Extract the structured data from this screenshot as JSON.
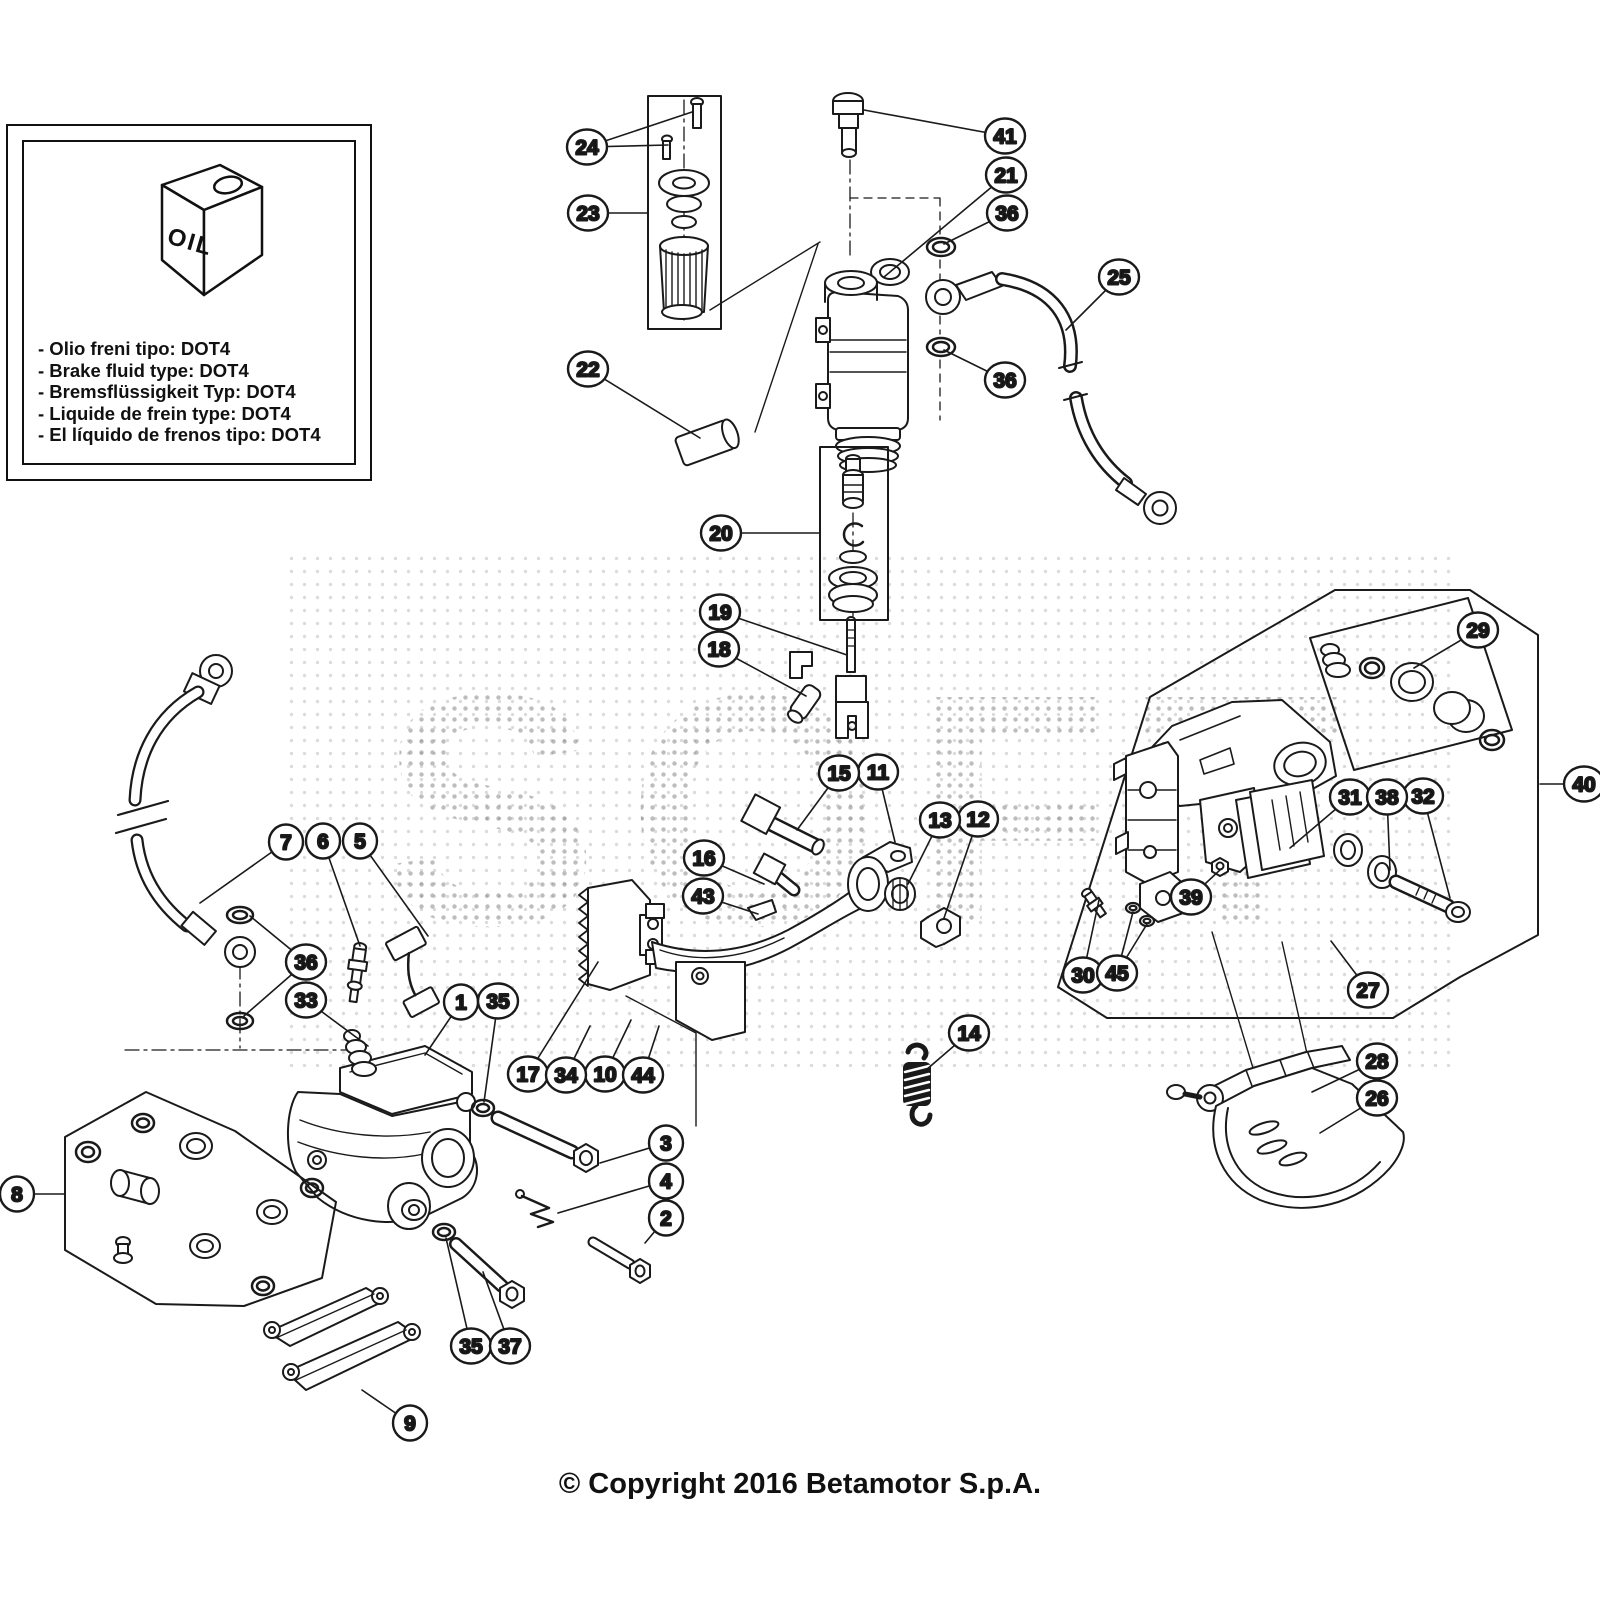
{
  "info_box": {
    "oil_label": "OIL",
    "lines": [
      "- Olio freni tipo: DOT4",
      "- Brake fluid type: DOT4",
      "- Bremsflüssigkeit Typ: DOT4",
      "- Liquide de frein type: DOT4",
      "- El líquido de frenos tipo: DOT4"
    ]
  },
  "watermark": {
    "text": "SOFT"
  },
  "copyright": "© Copyright 2016 Betamotor S.p.A.",
  "colors": {
    "line": "#1a1a1a",
    "background": "#ffffff",
    "watermark_dot": "#8f8f8f"
  },
  "callouts": [
    {
      "n": "1",
      "x": 461,
      "y": 1002,
      "to": [
        [
          425,
          1055
        ]
      ]
    },
    {
      "n": "2",
      "x": 666,
      "y": 1218,
      "to": [
        [
          645,
          1243
        ]
      ]
    },
    {
      "n": "3",
      "x": 666,
      "y": 1143,
      "to": [
        [
          600,
          1163
        ]
      ]
    },
    {
      "n": "4",
      "x": 666,
      "y": 1181,
      "to": [
        [
          558,
          1213
        ]
      ]
    },
    {
      "n": "5",
      "x": 360,
      "y": 841,
      "to": [
        [
          428,
          936
        ]
      ]
    },
    {
      "n": "6",
      "x": 323,
      "y": 841,
      "to": [
        [
          360,
          946
        ]
      ]
    },
    {
      "n": "7",
      "x": 286,
      "y": 842,
      "to": [
        [
          200,
          903
        ]
      ]
    },
    {
      "n": "8",
      "x": 17,
      "y": 1194,
      "to": [
        [
          64,
          1194
        ]
      ]
    },
    {
      "n": "9",
      "x": 410,
      "y": 1423,
      "to": [
        [
          362,
          1390
        ]
      ]
    },
    {
      "n": "10",
      "x": 605,
      "y": 1074,
      "to": [
        [
          631,
          1020
        ]
      ]
    },
    {
      "n": "11",
      "x": 878,
      "y": 772,
      "to": [
        [
          895,
          842
        ]
      ]
    },
    {
      "n": "12",
      "x": 978,
      "y": 819,
      "to": [
        [
          944,
          918
        ]
      ]
    },
    {
      "n": "13",
      "x": 940,
      "y": 820,
      "to": [
        [
          908,
          884
        ]
      ]
    },
    {
      "n": "14",
      "x": 969,
      "y": 1033,
      "to": [
        [
          926,
          1070
        ]
      ]
    },
    {
      "n": "15",
      "x": 839,
      "y": 773,
      "to": [
        [
          797,
          830
        ]
      ]
    },
    {
      "n": "16",
      "x": 704,
      "y": 858,
      "to": [
        [
          764,
          884
        ]
      ]
    },
    {
      "n": "17",
      "x": 528,
      "y": 1074,
      "to": [
        [
          598,
          962
        ]
      ]
    },
    {
      "n": "18",
      "x": 719,
      "y": 649,
      "to": [
        [
          806,
          696
        ]
      ]
    },
    {
      "n": "19",
      "x": 720,
      "y": 612,
      "to": [
        [
          847,
          655
        ]
      ]
    },
    {
      "n": "20",
      "x": 721,
      "y": 533,
      "to": [
        [
          820,
          533
        ]
      ]
    },
    {
      "n": "21",
      "x": 1006,
      "y": 175,
      "to": [
        [
          884,
          277
        ]
      ]
    },
    {
      "n": "22",
      "x": 588,
      "y": 369,
      "to": [
        [
          700,
          438
        ]
      ]
    },
    {
      "n": "23",
      "x": 588,
      "y": 213,
      "to": [
        [
          648,
          213
        ]
      ]
    },
    {
      "n": "24",
      "x": 587,
      "y": 147,
      "to": [
        [
          692,
          112
        ],
        [
          668,
          145
        ]
      ]
    },
    {
      "n": "25",
      "x": 1119,
      "y": 277,
      "to": [
        [
          1066,
          330
        ]
      ]
    },
    {
      "n": "26",
      "x": 1377,
      "y": 1098,
      "to": [
        [
          1320,
          1133
        ]
      ]
    },
    {
      "n": "27",
      "x": 1368,
      "y": 990,
      "to": [
        [
          1331,
          941
        ]
      ]
    },
    {
      "n": "28",
      "x": 1377,
      "y": 1061,
      "to": [
        [
          1312,
          1092
        ]
      ]
    },
    {
      "n": "29",
      "x": 1478,
      "y": 630,
      "to": [
        [
          1414,
          668
        ]
      ]
    },
    {
      "n": "30",
      "x": 1083,
      "y": 975,
      "to": [
        [
          1099,
          900
        ]
      ]
    },
    {
      "n": "31",
      "x": 1350,
      "y": 797,
      "to": [
        [
          1290,
          848
        ]
      ]
    },
    {
      "n": "32",
      "x": 1423,
      "y": 796,
      "to": [
        [
          1450,
          898
        ]
      ]
    },
    {
      "n": "33",
      "x": 306,
      "y": 1000,
      "to": [
        [
          368,
          1046
        ]
      ]
    },
    {
      "n": "34",
      "x": 566,
      "y": 1075,
      "to": [
        [
          590,
          1026
        ]
      ]
    },
    {
      "n": "35",
      "x": 498,
      "y": 1001,
      "to": [
        [
          484,
          1102
        ]
      ]
    },
    {
      "n": "35",
      "x": 471,
      "y": 1346,
      "to": [
        [
          446,
          1238
        ]
      ]
    },
    {
      "n": "36",
      "x": 1007,
      "y": 213,
      "to": [
        [
          944,
          244
        ]
      ]
    },
    {
      "n": "36",
      "x": 1005,
      "y": 380,
      "to": [
        [
          944,
          350
        ]
      ]
    },
    {
      "n": "36",
      "x": 306,
      "y": 962,
      "to": [
        [
          250,
          916
        ],
        [
          244,
          1016
        ]
      ]
    },
    {
      "n": "37",
      "x": 510,
      "y": 1346,
      "to": [
        [
          483,
          1272
        ]
      ]
    },
    {
      "n": "38",
      "x": 1387,
      "y": 797,
      "to": [
        [
          1390,
          870
        ]
      ]
    },
    {
      "n": "39",
      "x": 1191,
      "y": 897,
      "to": [
        [
          1221,
          869
        ]
      ]
    },
    {
      "n": "40",
      "x": 1584,
      "y": 784,
      "to": [
        [
          1540,
          784
        ]
      ]
    },
    {
      "n": "41",
      "x": 1005,
      "y": 136,
      "to": [
        [
          864,
          110
        ]
      ]
    },
    {
      "n": "43",
      "x": 703,
      "y": 896,
      "to": [
        [
          758,
          914
        ]
      ]
    },
    {
      "n": "44",
      "x": 643,
      "y": 1075,
      "to": [
        [
          659,
          1026
        ]
      ]
    },
    {
      "n": "45",
      "x": 1117,
      "y": 973,
      "to": [
        [
          1133,
          912
        ],
        [
          1147,
          924
        ]
      ]
    }
  ]
}
